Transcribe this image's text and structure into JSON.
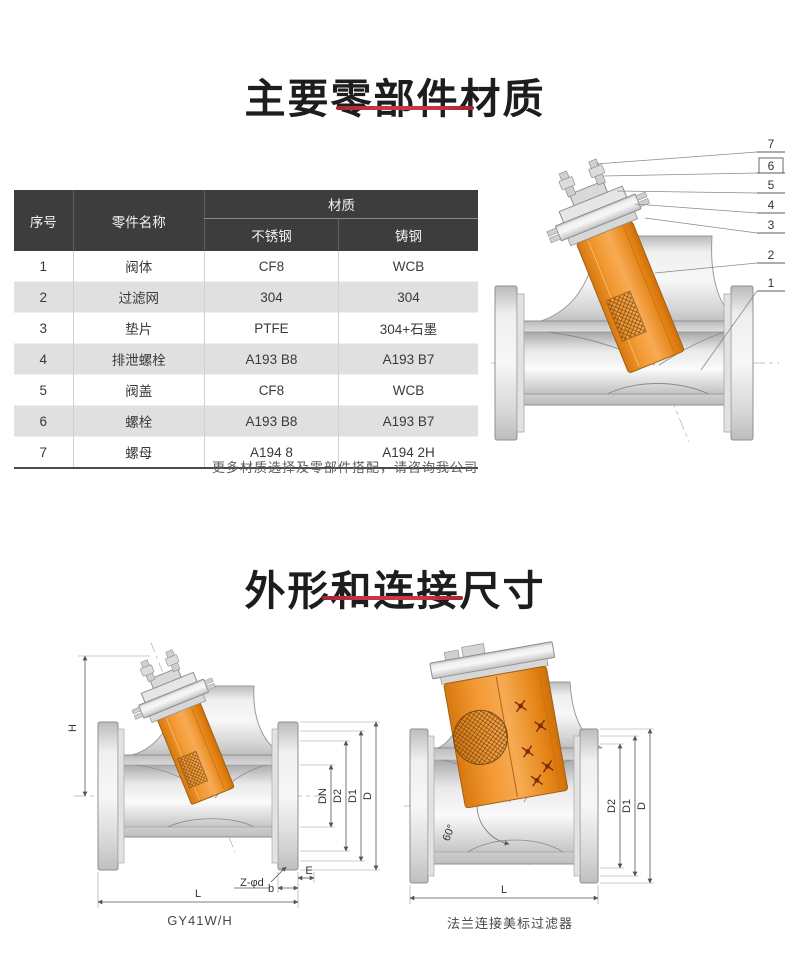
{
  "sections": {
    "materials_title": "主要零部件材质",
    "dimensions_title": "外形和连接尺寸"
  },
  "materials_table": {
    "col_index": "序号",
    "col_part": "零件名称",
    "col_material": "材质",
    "col_stainless": "不锈钢",
    "col_cast": "铸钢",
    "rows": [
      {
        "no": "1",
        "part": "阀体",
        "stainless": "CF8",
        "cast": "WCB"
      },
      {
        "no": "2",
        "part": "过滤网",
        "stainless": "304",
        "cast": "304"
      },
      {
        "no": "3",
        "part": "垫片",
        "stainless": "PTFE",
        "cast": "304+石墨"
      },
      {
        "no": "4",
        "part": "排泄螺栓",
        "stainless": "A193 B8",
        "cast": "A193 B7"
      },
      {
        "no": "5",
        "part": "阀盖",
        "stainless": "CF8",
        "cast": "WCB"
      },
      {
        "no": "6",
        "part": "螺栓",
        "stainless": "A193 B8",
        "cast": "A193 B7"
      },
      {
        "no": "7",
        "part": "螺母",
        "stainless": "A194 8",
        "cast": "A194 2H"
      }
    ],
    "note": "更多材质选择及零部件搭配，请咨询我公司"
  },
  "parts_diagram": {
    "callouts": [
      "7",
      "6",
      "5",
      "4",
      "3",
      "2",
      "1"
    ]
  },
  "outline_left": {
    "caption": "GY41W/H",
    "labels": {
      "H": "H",
      "L": "L",
      "DN": "DN",
      "D2": "D2",
      "D1": "D1",
      "D": "D",
      "bolt_holes": "Z-φd",
      "E": "E",
      "b": "b"
    }
  },
  "outline_right": {
    "caption": "法兰连接美标过滤器",
    "labels": {
      "angle": "60°",
      "D2": "D2",
      "D1": "D1",
      "D": "D",
      "L": "L"
    }
  },
  "colors": {
    "accent_red": "#cb3644",
    "header_bg": "#3d3d3d",
    "cartridge_orange": "#f0922e"
  }
}
